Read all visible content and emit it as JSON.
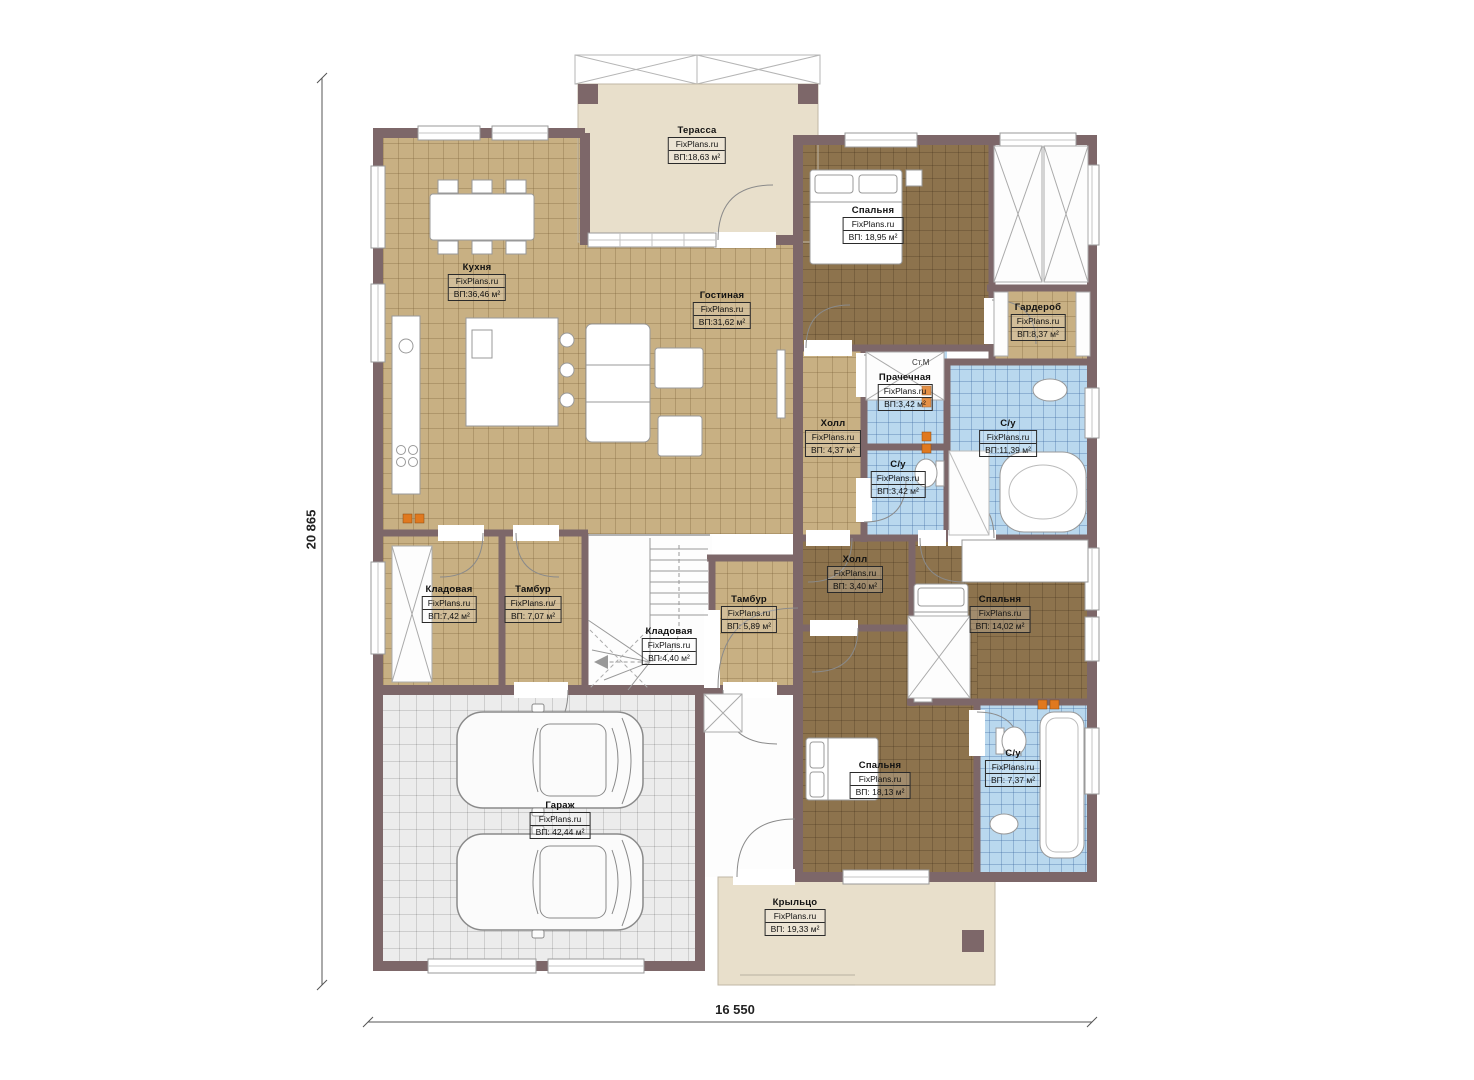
{
  "plan": {
    "brand": "FixPlans.ru",
    "dimensions": {
      "width": "16 550",
      "height": "20 865"
    },
    "marker_washing_machine": "Ст.М",
    "colors": {
      "wall": "#7d6769",
      "floor_tile_tan": "#c8b083",
      "floor_parquet_brown": "#8d734d",
      "floor_bath_blue": "#b9d8ee",
      "floor_garage_gray": "#ececec",
      "floor_outdoor_beige": "#e8dfcb",
      "socket_marker_orange": "#e0791f"
    },
    "rooms": [
      {
        "name": "Терасса",
        "brand": "FixPlans.ru",
        "area": "ВП:18,63 м²"
      },
      {
        "name": "Кухня",
        "brand": "FixPlans.ru",
        "area": "ВП:36,46 м²"
      },
      {
        "name": "Гостиная",
        "brand": "FixPlans.ru",
        "area": "ВП:31,62 м²"
      },
      {
        "name": "Спальня",
        "brand": "FixPlans.ru",
        "area": "ВП: 18,95 м²"
      },
      {
        "name": "Гардероб",
        "brand": "FixPlans.ru",
        "area": "ВП:8,37 м²"
      },
      {
        "name": "Прачечная",
        "brand": "FixPlans.ru",
        "area": "ВП:3,42 м²"
      },
      {
        "name": "Холл",
        "brand": "FixPlans.ru",
        "area": "ВП: 4,37 м²"
      },
      {
        "name": "С/у",
        "brand": "FixPlans.ru",
        "area": "ВП:11,39 м²"
      },
      {
        "name": "С/у",
        "brand": "FixPlans.ru",
        "area": "ВП:3,42 м²"
      },
      {
        "name": "Холл",
        "brand": "FixPlans.ru",
        "area": "ВП: 3,40 м²"
      },
      {
        "name": "Спальня",
        "brand": "FixPlans.ru",
        "area": "ВП: 14,02 м²"
      },
      {
        "name": "Кладовая",
        "brand": "FixPlans.ru",
        "area": "ВП:7,42 м²"
      },
      {
        "name": "Тамбур",
        "brand": "FixPlans.ru/",
        "area": "ВП: 7,07 м²"
      },
      {
        "name": "Тамбур",
        "brand": "FixPlans.ru",
        "area": "ВП: 5,89 м²"
      },
      {
        "name": "Кладовая",
        "brand": "FixPlans.ru",
        "area": "ВП:4,40 м²"
      },
      {
        "name": "Гараж",
        "brand": "FixPlans.ru",
        "area": "ВП: 42,44 м²"
      },
      {
        "name": "Спальня",
        "brand": "FixPlans.ru",
        "area": "ВП: 18,13 м²"
      },
      {
        "name": "С/у",
        "brand": "FixPlans.ru",
        "area": "ВП: 7,37 м²"
      },
      {
        "name": "Крыльцо",
        "brand": "FixPlans.ru",
        "area": "ВП: 19,33 м²"
      }
    ]
  }
}
